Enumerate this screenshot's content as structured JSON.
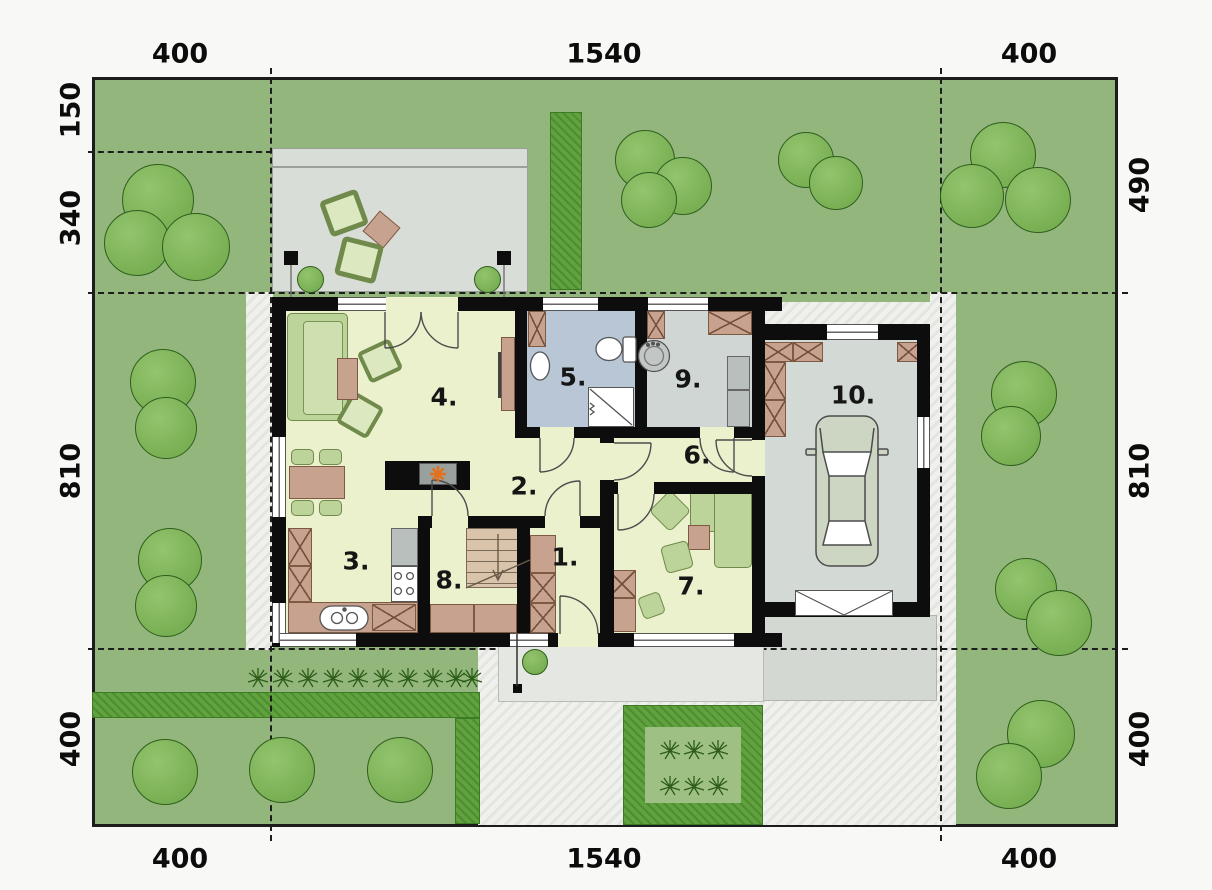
{
  "site": {
    "dimensions": {
      "top": [
        "400",
        "1540",
        "400"
      ],
      "bottom": [
        "400",
        "1540",
        "400"
      ],
      "left": [
        "150",
        "340",
        "810",
        "400"
      ],
      "right": [
        "490",
        "810",
        "400"
      ]
    },
    "rooms": [
      {
        "label": "1."
      },
      {
        "label": "2."
      },
      {
        "label": "3."
      },
      {
        "label": "4."
      },
      {
        "label": "5."
      },
      {
        "label": "6."
      },
      {
        "label": "7."
      },
      {
        "label": "8."
      },
      {
        "label": "9."
      },
      {
        "label": "10."
      }
    ],
    "colors": {
      "lawn": "#92b67c",
      "hedge": "#5fa23e",
      "path": "#f0f1ed",
      "terrace": "#d9ddd8",
      "driveway": "#d3d8d2",
      "floor": "#ebf0cd",
      "bathroom_floor": "#b8c6d5",
      "utility_floor": "#d0d6d4",
      "garage_floor": "#d3d9d5",
      "wall": "#0d0d0d",
      "furniture_green": "#bcd49a",
      "furniture_brown": "#c7a28e",
      "fireplace_accent": "#e2711d"
    }
  }
}
